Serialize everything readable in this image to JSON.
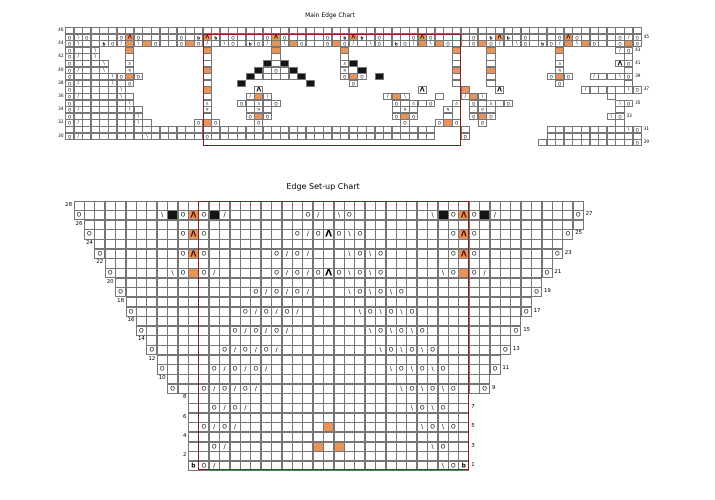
{
  "colors": {
    "orange_cell": "#E8935C",
    "black_cell": "#141414",
    "grid_line": "#767676",
    "repeat_box": "#8B1C1C",
    "background": "#ffffff"
  },
  "symbols": {
    "O": {
      "glyph": "O",
      "name": "yarn-over",
      "cls": "glyph-O"
    },
    "/": {
      "glyph": "/",
      "name": "k2tog",
      "cls": "glyph-sl"
    },
    "\\": {
      "glyph": "\\",
      "name": "ssk",
      "cls": "glyph-sl"
    },
    "A": {
      "glyph": "Λ",
      "name": "central-double-decrease-orange",
      "cls": "glyph-lam",
      "fill": "orange"
    },
    "a": {
      "glyph": "Λ",
      "name": "central-double-decrease",
      "cls": "glyph-biglam"
    },
    "d": {
      "glyph": "Δ",
      "name": "gather-top",
      "cls": "glyph-delta"
    },
    "n": {
      "glyph": "N",
      "name": "gather-bottom",
      "cls": "glyph-N"
    },
    "b": {
      "glyph": "b",
      "name": "bobble",
      "cls": "glyph-b"
    },
    "o": {
      "glyph": "",
      "name": "orange-highlight",
      "fill": "orange"
    },
    "#": {
      "glyph": "",
      "name": "no-stitch-black",
      "fill": "black"
    },
    ".": {
      "glyph": "",
      "name": "knit"
    }
  },
  "main_chart": {
    "title": "Main Edge Chart",
    "repeat_box": {
      "col_start": 16,
      "col_end": 45,
      "row_start": 45,
      "row_end": 29
    },
    "rows": [
      {
        "num": 46,
        "cells": "..................................................................."
      },
      {
        "num": 45,
        "cells": "O\\O...OAO....O.bAb.O...OAO....O.bAb.O...OAO....O.bAb.O...OAO....O/O"
      },
      {
        "num": 44,
        "cells": "O\\..bO/o\\oO..OoO/.\\O.bO/o\\oO..OoO/.\\O.bO/o\\oO..OoO/.\\O.bO/o\\oO..OoO"
      },
      {
        "num": 43,
        "cells": "O..\\   o        o       o       o            o   o       o      /O"
      },
      {
        "num": 42,
        "cells": "O/.\\   .        .       .       .            .   .       .       ."
      },
      {
        "num": 41,
        "cells": "O...\\  d        .      #.#      d#           .   .       d      aO"
      },
      {
        "num": 40,
        "cells": "O/..\\  n        o     #.O.#     n #          o   o       n       ."
      },
      {
        "num": 39,
        "cells": "O....\\OoO       .    #.....#    OoO #        .   .      OoO  /..\\O"
      },
      {
        "num": 38,
        "cells": "O/...\\.O        .   #       #    O           .   .       O       ."
      },
      {
        "num": 37,
        "cells": "O.....\\         o     a                  a    o   a         /....\\O"
      },
      {
        "num": 36,
        "cells": "O/....\\.        .    /o\\             /o\\   .  /o\\              ."
      },
      {
        "num": 35,
        "cells": "O......\\        d   O.d.O             O.d.O  d O.d.O            \\O"
      },
      {
        "num": 34,
        "cells": "O/.....\\.       n    .n.              .n.   n  .n.              ."
      },
      {
        "num": 33,
        "cells": "O.......\\       .    OoO              OoO   .  OoO             \\O"
      },
      {
        "num": 32,
        "cells": "O/......\\.     OoO    O                O   OoO  O               ."
      },
      {
        "num": 31,
        "cells": "...........................................   .         .........\\O"
      },
      {
        "num": 30,
        "cells": "O/.......\\......O..........................   O         ..........."
      },
      {
        "num": 29,
        "cells": "                                                       ...........O"
      }
    ]
  },
  "setup_chart": {
    "title": "Edge Set-up Chart",
    "repeat_box": {
      "col_start": 12,
      "col_end": 37,
      "row_start": 28,
      "row_end": 1
    },
    "rows": [
      {
        "num": 28,
        "cells": "................................................."
      },
      {
        "num": 27,
        "cells": "O.......\\#OAO#/.......O/.\\O.......\\#OAO#/.......O"
      },
      {
        "num": 26,
        "cells": " ................................................"
      },
      {
        "num": 25,
        "cells": " O........OAO........O/OaO\\O........OAO........O "
      },
      {
        "num": 24,
        "cells": "  .............................................  "
      },
      {
        "num": 23,
        "cells": "  O.......OAO......O/O/...\\O\\O......OAO.......O  "
      },
      {
        "num": 22,
        "cells": "   ...........................................   "
      },
      {
        "num": 21,
        "cells": "   O.....\\OoO/.....O/O/OaO\\O\\O.....\\OoO/.....O   "
      },
      {
        "num": 20,
        "cells": "    .........................................    "
      },
      {
        "num": 19,
        "cells": "    O............O/O/O/...\\O\\O\\O............O    "
      },
      {
        "num": 18,
        "cells": "     .......................................     "
      },
      {
        "num": 17,
        "cells": "     O..........O/O/O/.....\\O\\O\\O..........O     "
      },
      {
        "num": 16,
        "cells": "      .....................................      "
      },
      {
        "num": 15,
        "cells": "      O........O/O/O/.......\\O\\O\\O........O      "
      },
      {
        "num": 14,
        "cells": "       ...................................       "
      },
      {
        "num": 13,
        "cells": "       O......O/O/O/.........\\O\\O\\O......O       "
      },
      {
        "num": 12,
        "cells": "        .................................        "
      },
      {
        "num": 11,
        "cells": "        O....O/O/O/...........\\O\\O\\O....O        "
      },
      {
        "num": 10,
        "cells": "         ...............................         "
      },
      {
        "num": 9,
        "cells": "         O..O/O/O/.............\\O\\O\\O..O         "
      },
      {
        "num": 8,
        "cells": "           ...........................           "
      },
      {
        "num": 7,
        "cells": "           ..O/O/...............\\O\\O..           "
      },
      {
        "num": 6,
        "cells": "           ...........................           "
      },
      {
        "num": 5,
        "cells": "           .O/O/........o........\\O\\O.           "
      },
      {
        "num": 4,
        "cells": "           ...........................           "
      },
      {
        "num": 3,
        "cells": "           ..O/........o.o........\\O..           "
      },
      {
        "num": 2,
        "cells": "           ...........................           "
      },
      {
        "num": 1,
        "cells": "           bO/.....................\\Ob           "
      }
    ]
  }
}
